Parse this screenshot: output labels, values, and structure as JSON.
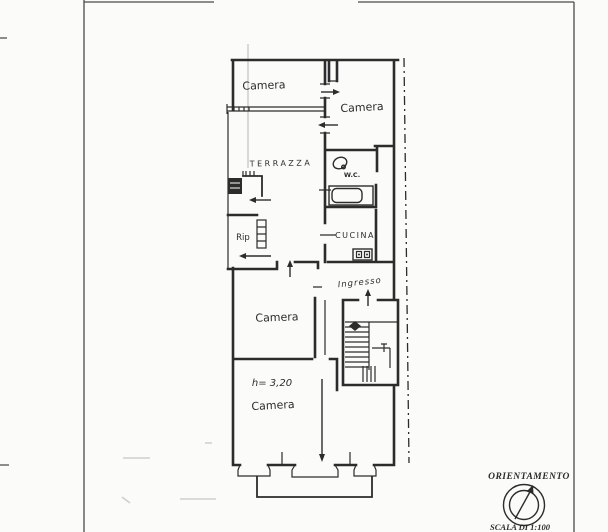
{
  "colors": {
    "ink": "#2c2c2c",
    "paper": "#fbfbf9",
    "frame": "#4a4a4a",
    "faint": "#b9b7b2"
  },
  "plan": {
    "rooms": {
      "camera_top_left": "Camera",
      "camera_top_right": "Camera",
      "terrazza": "TERRAZZA",
      "wc": "W.C.",
      "ripostiglio": "Rip",
      "cucina": "CUCINA",
      "ingresso": "Ingresso",
      "camera_middle": "Camera",
      "camera_bottom": "Camera"
    },
    "annotations": {
      "ceiling_height": "h= 3,20"
    }
  },
  "legend": {
    "orientation_title": "ORIENTAMENTO",
    "scale_label": "SCALA DI 1:100"
  }
}
